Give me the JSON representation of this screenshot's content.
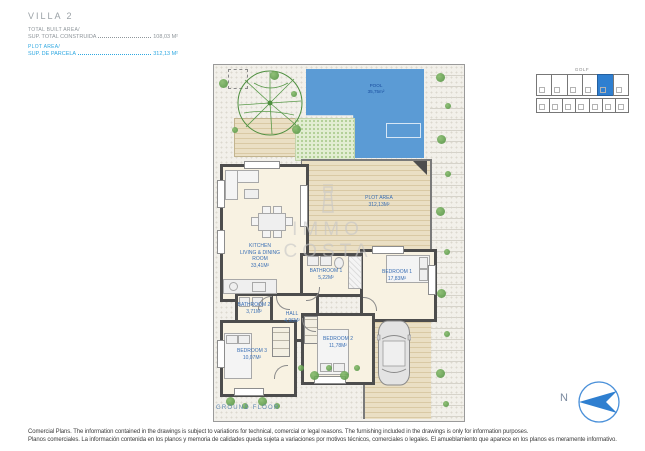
{
  "header": {
    "title": "VILLA 2",
    "built": {
      "label": "TOTAL BUILT AREA/",
      "line": "SUP. TOTAL CONSTRUIDA",
      "value": "108,03 M²"
    },
    "plot": {
      "label": "PLOT AREA/",
      "line": "SUP. DE PARCELA",
      "value": "312,13 M²"
    }
  },
  "inset": {
    "caption": "GOLF"
  },
  "rooms": {
    "pool": {
      "name": "POOL",
      "area": "35,75m²"
    },
    "kitchen": {
      "line1": "KITCHEN",
      "line2": "LIVING & DINING",
      "line3": "ROOM",
      "area": "33,41m²"
    },
    "plot_area": {
      "name": "PLOT AREA",
      "area": "312,13m²"
    },
    "bathroom1": {
      "name": "BATHROOM 1",
      "area": "5,22m²"
    },
    "bedroom1": {
      "name": "BEDROOM 1",
      "area": "17,83m²"
    },
    "bathroom2": {
      "name": "BATHROOM 2",
      "area": "3,71m²"
    },
    "hall": {
      "name": "HALL",
      "area": "4,96m²"
    },
    "bedroom2": {
      "name": "BEDROOM 2",
      "area": "11,78m²"
    },
    "bedroom3": {
      "name": "BEDROOM 3",
      "area": "10,07m²"
    }
  },
  "floor_label": "GROUND FLOOR",
  "compass_label": "N",
  "watermark": {
    "line1": "IMMO",
    "line2": "COSTA"
  },
  "footer": {
    "en": "Comercial Plans. The information contained in the drawings is subject to variations for technical, comercial or legal reasons. The furnishing included in the drawings is only for information purposes.",
    "es": "Planos comerciales. La información contenida en los planos y memoria de calidades queda sujeta a variaciones por motivos técnicos, comerciales o legales. El amueblamiento que aparece en los planos es meramente informativo."
  },
  "colors": {
    "accent_blue": "#2fa8e1",
    "pool_blue": "#5b9bd5",
    "label_blue": "#3a6fb5",
    "deck_tan": "#eadfc4",
    "grass_green": "#e2edd2",
    "wall_gray": "#4d4d4d"
  }
}
